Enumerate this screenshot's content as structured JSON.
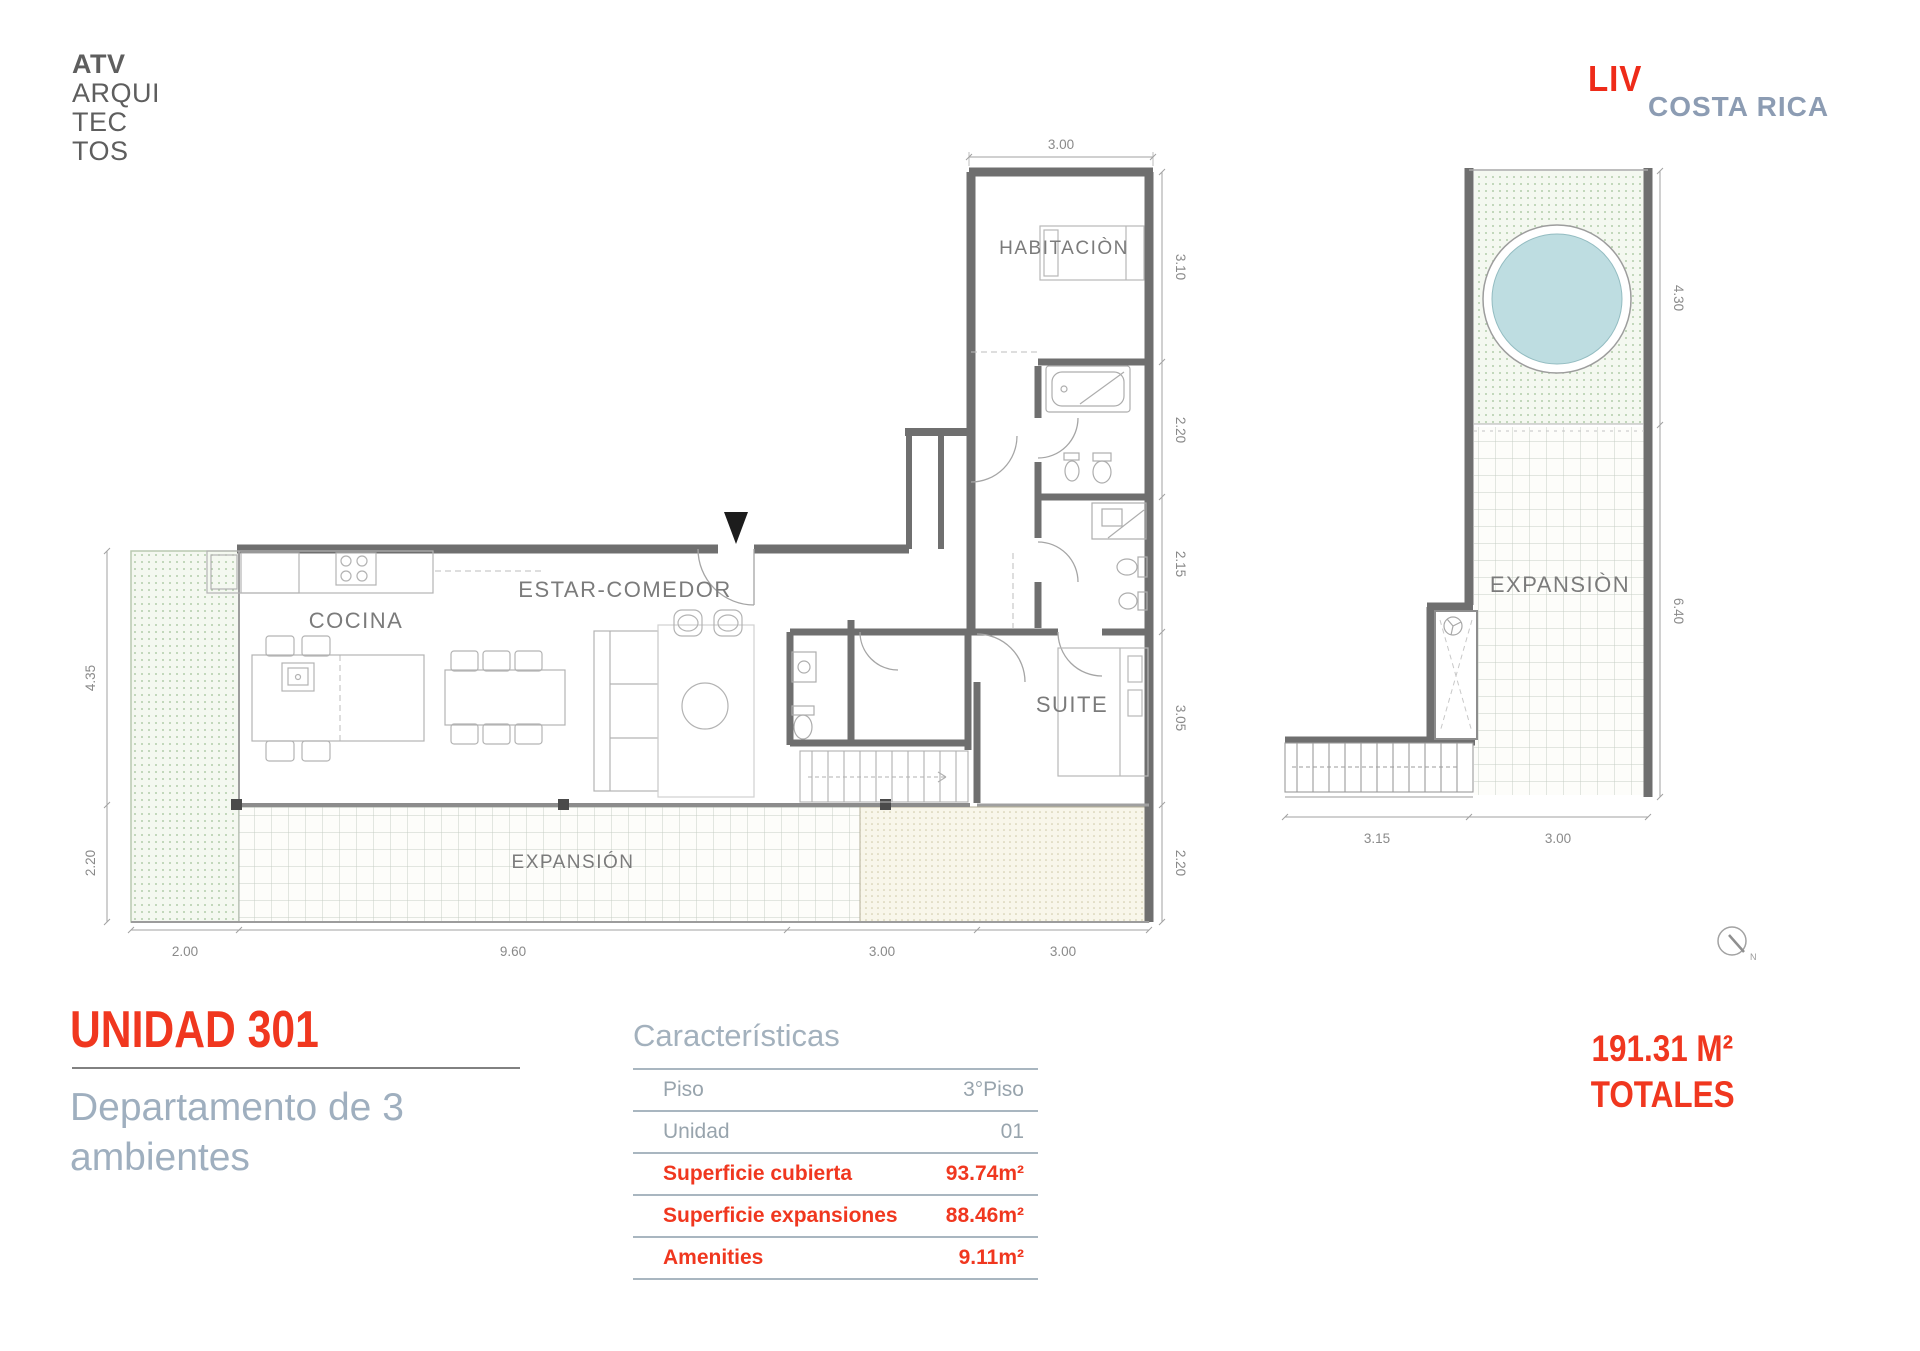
{
  "branding": {
    "architect": {
      "line1": "ATV",
      "line2": "ARQUI",
      "line3": "TEC",
      "line4": "TOS"
    },
    "developer": {
      "mark": "LIV",
      "name": "COSTA RICA"
    }
  },
  "main_plan": {
    "rooms": {
      "habitacion": "HABITACIÒN",
      "estar_comedor": "ESTAR-COMEDOR",
      "cocina": "COCINA",
      "suite": "SUITE",
      "expansion": "EXPANSIÓN"
    },
    "dims": {
      "top": "3.00",
      "right1": "3.10",
      "right2": "2.20",
      "right3": "2.15",
      "right4": "3.05",
      "right5": "2.20",
      "left1": "4.35",
      "left2": "2.20",
      "bottom1": "2.00",
      "bottom2": "9.60",
      "bottom3": "3.00",
      "bottom4": "3.00"
    }
  },
  "amenity_plan": {
    "room": "EXPANSIÒN",
    "dims": {
      "right1": "4.30",
      "right2": "6.40",
      "bottom1": "3.15",
      "bottom2": "3.00"
    },
    "compass": "N"
  },
  "title_block": {
    "title": "UNIDAD 301",
    "subtitle1": "Departamento de 3",
    "subtitle2": "ambientes"
  },
  "characteristics": {
    "heading": "Características",
    "rows": [
      {
        "label": "Piso",
        "value": "3°Piso"
      },
      {
        "label": "Unidad",
        "value": "01"
      },
      {
        "label": "Superficie cubierta",
        "value": "93.74m²"
      },
      {
        "label": "Superficie expansiones",
        "value": "88.46m²"
      },
      {
        "label": "Amenities",
        "value": "9.11m²"
      }
    ]
  },
  "totals": {
    "value": "191.31 M²",
    "label": "TOTALES"
  },
  "colors": {
    "accent_red": "#f0371f",
    "brand_red": "#ee2b19",
    "muted_blue": "#9fafbf",
    "brand_gray_blue": "#8c9cb3",
    "wall_gray": "#6f6f6f",
    "pool_fill": "#bedde1"
  }
}
